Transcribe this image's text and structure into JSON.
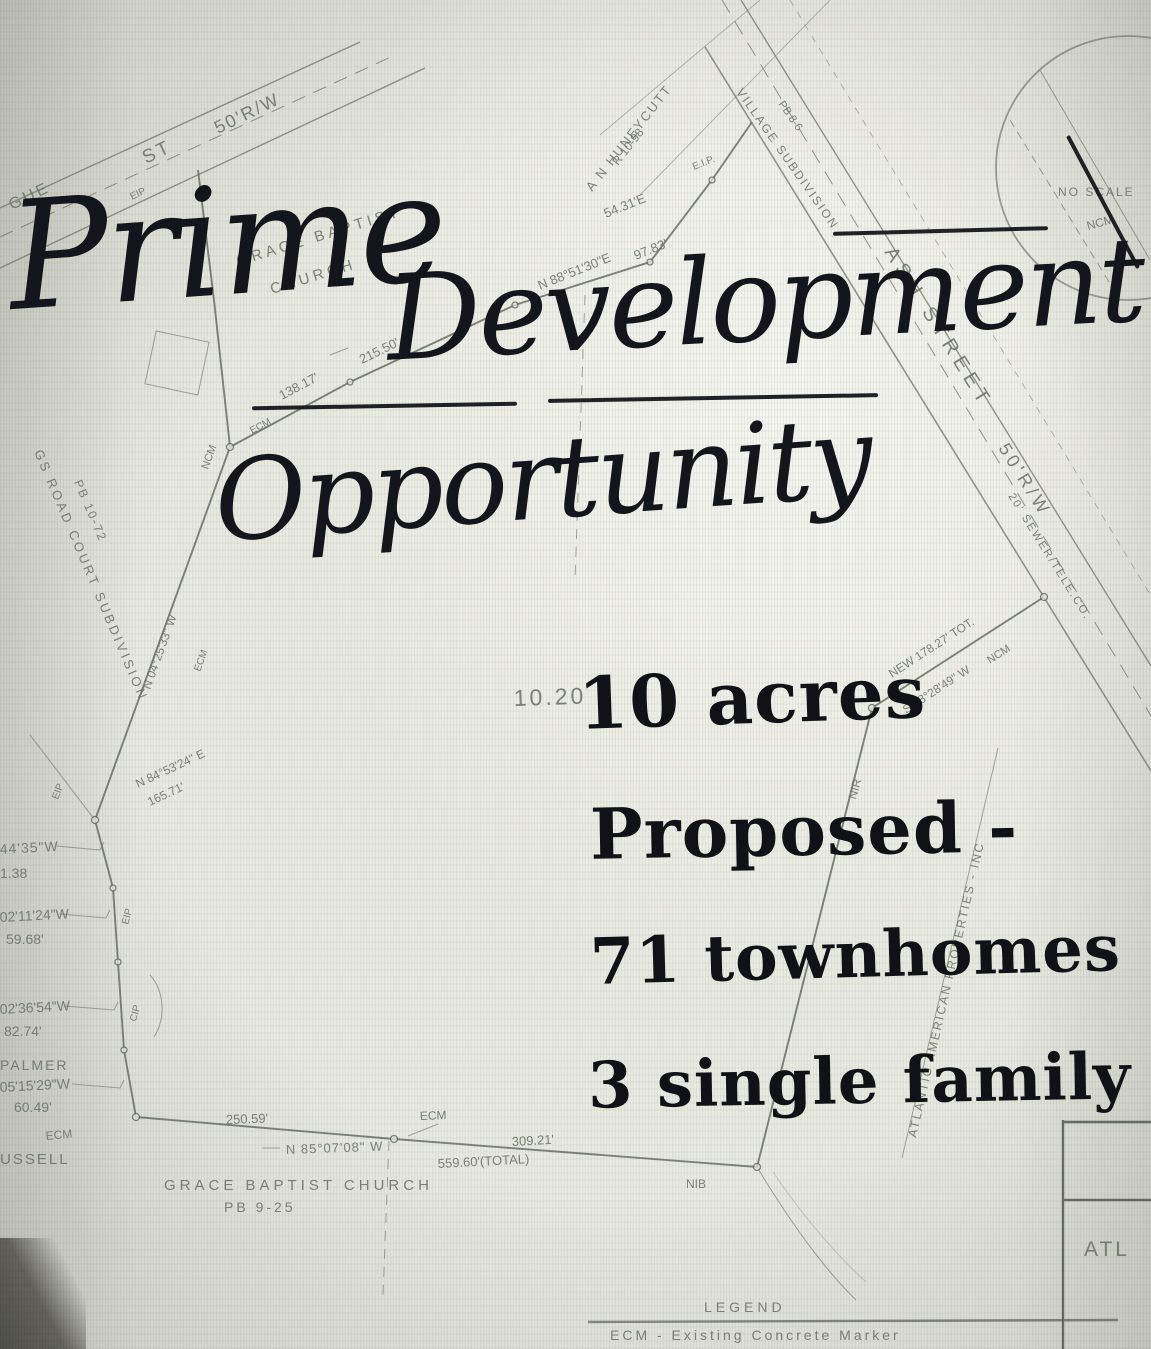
{
  "overlay": {
    "title_word1": "Prime",
    "title_word2": "Development",
    "title_line2": "Opportunity",
    "stat_acres": "10 acres",
    "stat_proposed": "Proposed -",
    "stat_townhomes": "71 townhomes",
    "stat_single": "3 single family"
  },
  "map": {
    "labels": {
      "street1_name": "GUE",
      "street1_st": "ST",
      "street1_rw": "50'R/W",
      "street1_eip": "EIP",
      "church1a": "GRACE BAPTIST",
      "church1b": "CHURCH",
      "huneycutt": "A N HUNEYCUTT",
      "huneycutt_ref": "R 10-98",
      "eip_top": "E.I.P.",
      "b5431": "54.31'E",
      "b8851": "N 88°51'30\"E",
      "d9783": "97.83'",
      "d21550": "215.50'",
      "d13817": "138.17'",
      "ecm_top": "ECM",
      "ncm_top": "NCM",
      "b042533": "N 04°25'33\" W",
      "ecm_left": "ECM",
      "eip_left0": "EIP",
      "b845324": "N 84°53'24\" E",
      "d16571": "165.71'",
      "w4435": "44'35\"W",
      "d138": "1.38",
      "w021124": "02'11'24\"W",
      "d5968": "59.68'",
      "eip_left2": "EIP",
      "w023654": "02'36'54\"W",
      "d8274": "82.74'",
      "cip": "CIP",
      "palmer": "PALMER",
      "w051529": "05'15'29\"W",
      "d6049": "60.49'",
      "russell": "USSELL",
      "ecm_bl": "ECM",
      "d25059": "250.59'",
      "b850708": "N 85°07'08\" W",
      "d55960": "559.60'(TOTAL)",
      "ecm_bm": "ECM",
      "d30921": "309.21'",
      "church2a": "GRACE BAPTIST CHURCH",
      "church2b": "PB 9-25",
      "nib": "NIB",
      "nir": "NIR",
      "new17827": "NEW 178.27' TOT.",
      "b582849": "S 58°28'49\" W",
      "ncm_right": "NCM",
      "ash1": "ASH STREET",
      "ash2": "50'R/W",
      "easement": "20' SEWER/TELE.CO.",
      "village1": "VILLAGE SUBDIVISION",
      "village2": "PB 8-6",
      "atlantic": "ATLANTIC AMERICAN PROPERTIES - INC",
      "subdiv_left": "GS ROAD COURT SUBDIVISION",
      "subdiv_left_ref": "PB 10-72",
      "acres_print": "10.20",
      "atl": "ATL",
      "no_scale": "NO SCALE",
      "ncm_circle": "NCM"
    },
    "legend": {
      "title": "LEGEND",
      "ecm": "ECM - Existing Concrete Marker"
    }
  },
  "colors": {
    "paper": "#e8e9e0",
    "map_ink": "#6e7566",
    "marker_ink": "#14161d"
  }
}
